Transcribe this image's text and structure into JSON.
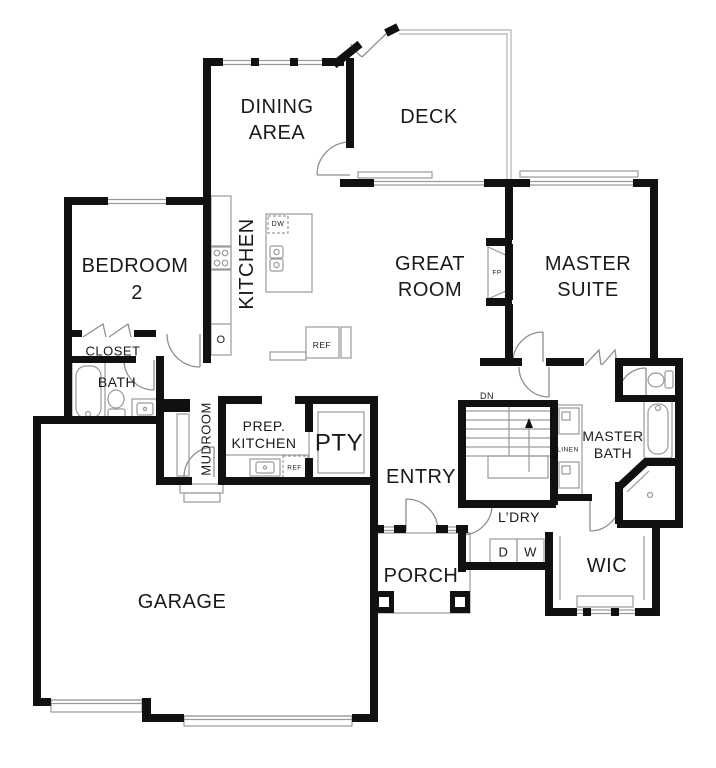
{
  "floorplan": {
    "rooms": {
      "dining": {
        "l1": "DINING",
        "l2": "AREA"
      },
      "deck": "DECK",
      "bedroom2": {
        "l1": "BEDROOM",
        "l2": "2"
      },
      "kitchen": "KITCHEN",
      "great_room": {
        "l1": "GREAT",
        "l2": "ROOM"
      },
      "master_suite": {
        "l1": "MASTER",
        "l2": "SUITE"
      },
      "closet": "CLOSET",
      "bath": "BATH",
      "mudroom": "MUDROOM",
      "prep_kitchen": {
        "l1": "PREP.",
        "l2": "KITCHEN"
      },
      "pantry": "PTY",
      "entry": "ENTRY",
      "master_bath": {
        "l1": "MASTER",
        "l2": "BATH"
      },
      "laundry": "L’DRY",
      "linen": "LINEN",
      "wic": "WIC",
      "porch": "PORCH",
      "garage": "GARAGE"
    },
    "annotations": {
      "stairs_down": "DN",
      "fireplace": "FP",
      "oven": "O",
      "dishwasher": "DW",
      "refrigerator": "REF",
      "prep_refrigerator": "REF",
      "dryer": "D",
      "washer": "W"
    },
    "colors": {
      "wall": "#111111",
      "thin_line": "#9a9a9a",
      "light_line": "#bdbdbd",
      "background": "#ffffff",
      "text": "#1a1a1a"
    }
  }
}
